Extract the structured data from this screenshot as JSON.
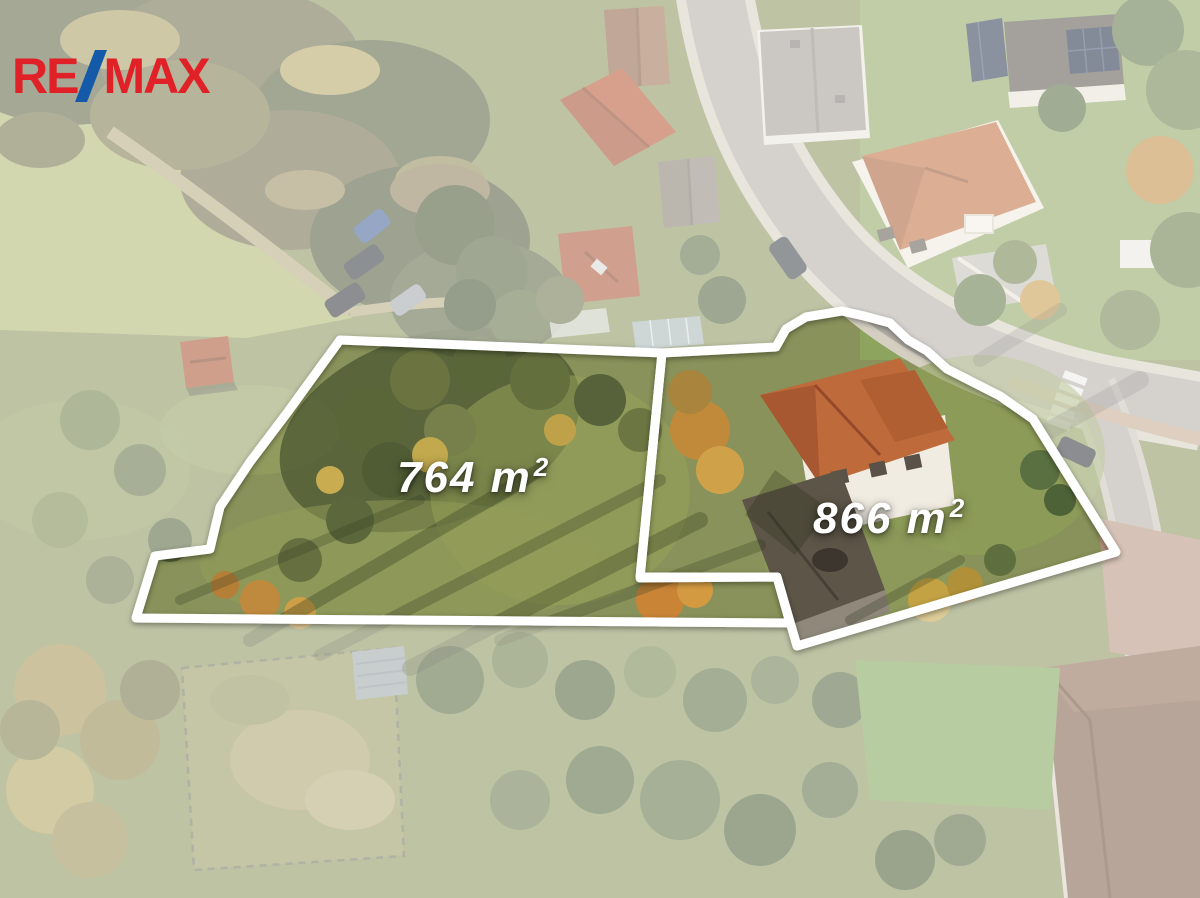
{
  "image": {
    "width": 1200,
    "height": 898
  },
  "branding": {
    "agency": "RE/MAX",
    "logo_text_1": "RE",
    "logo_slash": "/",
    "logo_text_2": "MAX",
    "logo_red": "#e02127",
    "logo_blue": "#155aa9"
  },
  "overlay": {
    "color": "#ffffff",
    "opacity": 0.45,
    "outline_color": "#ffffff",
    "outline_width": 9
  },
  "plots": [
    {
      "name": "left-plot",
      "area_label": "764 m²",
      "label": {
        "text": "764 m",
        "sup": "2",
        "x": 397,
        "y": 453
      },
      "points": [
        [
          340,
          340
        ],
        [
          662,
          353
        ],
        [
          640,
          577
        ],
        [
          777,
          577
        ],
        [
          790,
          623
        ],
        [
          136,
          618
        ],
        [
          155,
          556
        ],
        [
          210,
          549
        ],
        [
          220,
          507
        ],
        [
          250,
          462
        ],
        [
          287,
          413
        ]
      ]
    },
    {
      "name": "right-plot",
      "area_label": "866 m²",
      "label": {
        "text": "866 m",
        "sup": "2",
        "x": 813,
        "y": 494
      },
      "points": [
        [
          662,
          353
        ],
        [
          776,
          347
        ],
        [
          786,
          329
        ],
        [
          806,
          317
        ],
        [
          842,
          311
        ],
        [
          864,
          316
        ],
        [
          890,
          323
        ],
        [
          908,
          340
        ],
        [
          927,
          351
        ],
        [
          947,
          369
        ],
        [
          1000,
          396
        ],
        [
          1033,
          419
        ],
        [
          1116,
          552
        ],
        [
          797,
          646
        ],
        [
          777,
          577
        ],
        [
          640,
          578
        ]
      ]
    }
  ]
}
